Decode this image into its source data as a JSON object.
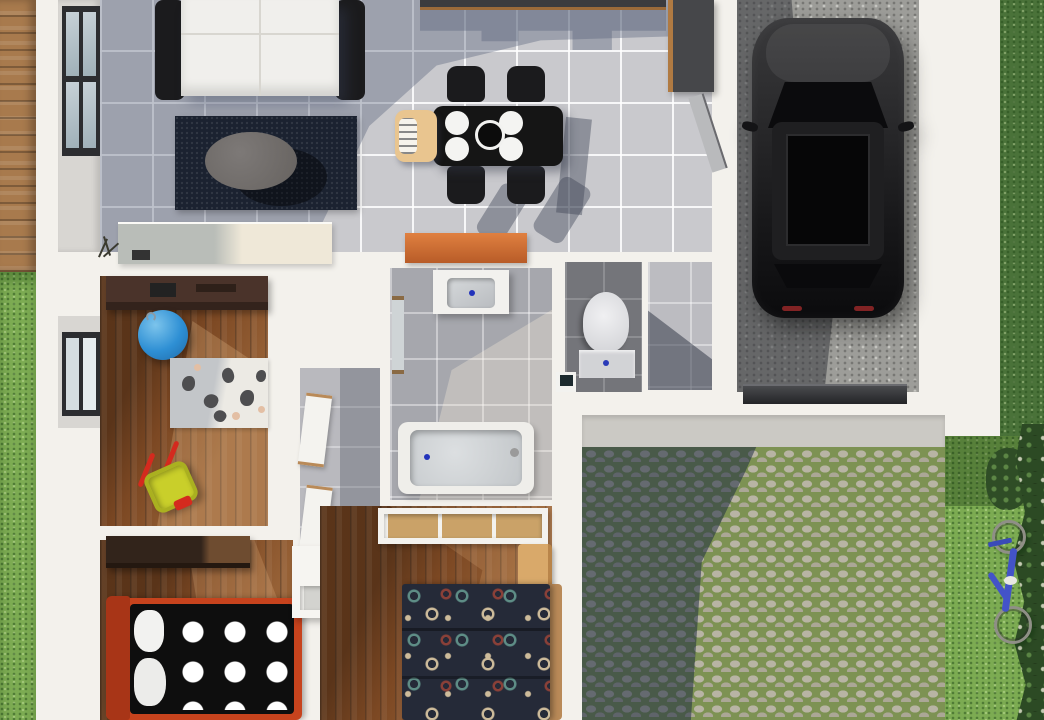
{
  "scene": {
    "title": "Top-down 3D architectural floor plan render of a single-storey house with garage, patio and garden",
    "view": "top-down aerial",
    "style": "photorealistic 3D render",
    "visible_text": "none"
  },
  "palette": {
    "wall": "#f3f1ec",
    "tile": "#c9c9cd",
    "bath_tile": "#a6a7ad",
    "wc_tile": "#74757a",
    "hall_tile": "#b9b9be",
    "wood": "#7c4823",
    "deck": "#a87a4d",
    "desk_brown": "#4a332a",
    "grass": "#7cab52",
    "grass_dark": "#4a7239",
    "bush": "#2c4a24",
    "cobble": "#b8b4a4",
    "moss": "#7d9253",
    "concrete": "#9d9d99",
    "sofa": "#f0efec",
    "furn_black": "#1b1b1d",
    "rug_navy": "#1b2230",
    "table_black": "#151515",
    "highchair_tan": "#e9c58f",
    "orange": "#d2713a",
    "car_black": "#1a1a1c",
    "red_bed": "#c7431d",
    "navy_bed": "#252a38",
    "ball_blue": "#2e8fd4",
    "toy_yellow": "#c9cf2a",
    "toy_red": "#d42a1e",
    "bike_blue": "#4353c8"
  },
  "rooms": [
    {
      "id": "living-room",
      "label": "Living room",
      "floor": "grey ceramic tile",
      "objects": [
        "white two-seat sofa with black arms",
        "dark navy area rug",
        "grey oval coffee table",
        "cream sideboard",
        "twig plant",
        "window on left wall"
      ]
    },
    {
      "id": "dining-area",
      "label": "Dining area / kitchen",
      "floor": "grey ceramic tile",
      "objects": [
        "black dining table",
        "four black chairs",
        "four white plates",
        "black centre bowl",
        "wooden high chair",
        "dark kitchen counter",
        "tall dark cabinet",
        "orange sideboard",
        "open door to garage"
      ]
    },
    {
      "id": "garage",
      "label": "Garage",
      "floor": "concrete",
      "objects": [
        "black SUV seen from above",
        "garage door threshold"
      ]
    },
    {
      "id": "kids-room",
      "label": "Kids playroom",
      "floor": "hardwood",
      "objects": [
        "brown desk",
        "blue gym ball",
        "animal-print rug",
        "red and yellow toy wheelbarrow",
        "window on left wall"
      ]
    },
    {
      "id": "bathroom",
      "label": "Bathroom",
      "floor": "grey tile",
      "objects": [
        "vanity sink with blue drain",
        "wall mirror",
        "bathtub with blue drain"
      ]
    },
    {
      "id": "wc",
      "label": "Toilet room",
      "floor": "dark grey tile",
      "objects": [
        "toilet",
        "small waste bin"
      ]
    },
    {
      "id": "hallway",
      "label": "Hallway",
      "floor": "grey tile",
      "objects": [
        "two white interior doors with wood trim"
      ]
    },
    {
      "id": "entry",
      "label": "Entry vestibule",
      "floor": "grey tile",
      "objects": []
    },
    {
      "id": "bedroom-1",
      "label": "Bedroom with polka-dot bed",
      "floor": "hardwood",
      "objects": [
        "dark wardrobe",
        "red-framed bed with black white-dotted duvet",
        "white pillows",
        "white shelving unit"
      ]
    },
    {
      "id": "bedroom-2",
      "label": "Bedroom with patterned bed",
      "floor": "hardwood",
      "objects": [
        "built-in closet with wood shelves",
        "light wood nightstand",
        "navy circle-patterned duvet with wood bed frame"
      ]
    },
    {
      "id": "patio",
      "label": "Cobblestone patio and driveway apron",
      "floor": "cobblestone with moss joints",
      "objects": []
    },
    {
      "id": "yard",
      "label": "Garden",
      "floor": "lawn",
      "objects": [
        "wooden deck strip",
        "blue bicycle lying on grass",
        "flowering shrubs along right edge"
      ]
    }
  ]
}
